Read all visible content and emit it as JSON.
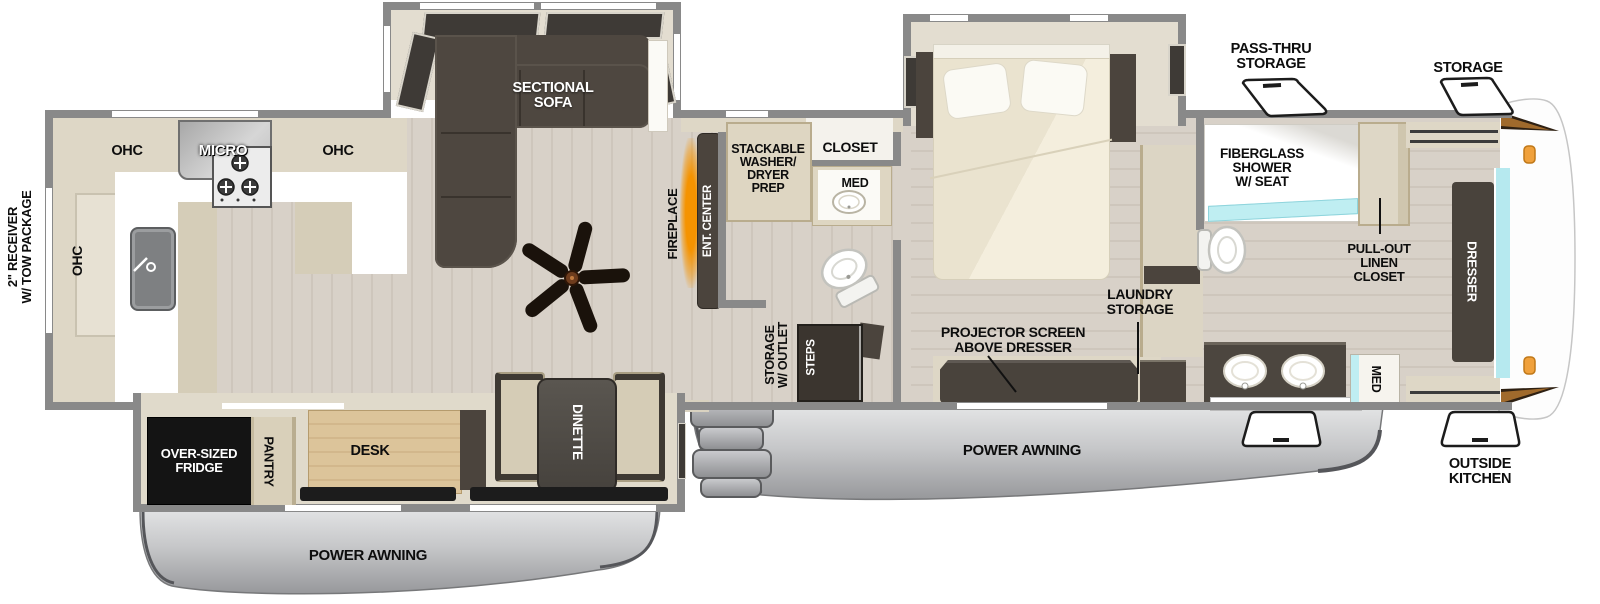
{
  "labels": {
    "hitch": "2\" RECEIVER\nW/ TOW PACKAGE",
    "ohc_rear": "OHC",
    "ohc_left": "OHC",
    "micro": "MICRO",
    "ohc_right": "OHC",
    "sectional_sofa": "SECTIONAL\nSOFA",
    "fireplace": "FIREPLACE",
    "ent_center": "ENT. CENTER",
    "washer_prep": "STACKABLE\nWASHER/\nDRYER\nPREP",
    "closet": "CLOSET",
    "med_mid": "MED",
    "storage_outlet": "STORAGE\nW/ OUTLET",
    "steps": "STEPS",
    "projector": "PROJECTOR SCREEN\nABOVE DRESSER",
    "laundry": "LAUNDRY\nSTORAGE",
    "shower": "FIBERGLASS\nSHOWER\nW/ SEAT",
    "linen": "PULL-OUT\nLINEN\nCLOSET",
    "med_front": "MED",
    "dresser": "DRESSER",
    "pass_thru": "PASS-THRU\nSTORAGE",
    "storage": "STORAGE",
    "outside_kitchen": "OUTSIDE\nKITCHEN",
    "awning_left": "POWER AWNING",
    "awning_right": "POWER AWNING",
    "fridge": "OVER-SIZED\nFRIDGE",
    "pantry": "PANTRY",
    "desk": "DESK",
    "dinette": "DINETTE"
  },
  "colors": {
    "wall_gray": "#898989",
    "cabinet_beige": "#ded7c6",
    "dark_furniture": "#4b443d",
    "awning_gray": "#b9babd",
    "fireplace_orange": "#f59300",
    "window_cyan": "#b6e9ef",
    "clearance_light_orange": "#f0a13c",
    "floor_wood": "#d8d1c8"
  }
}
